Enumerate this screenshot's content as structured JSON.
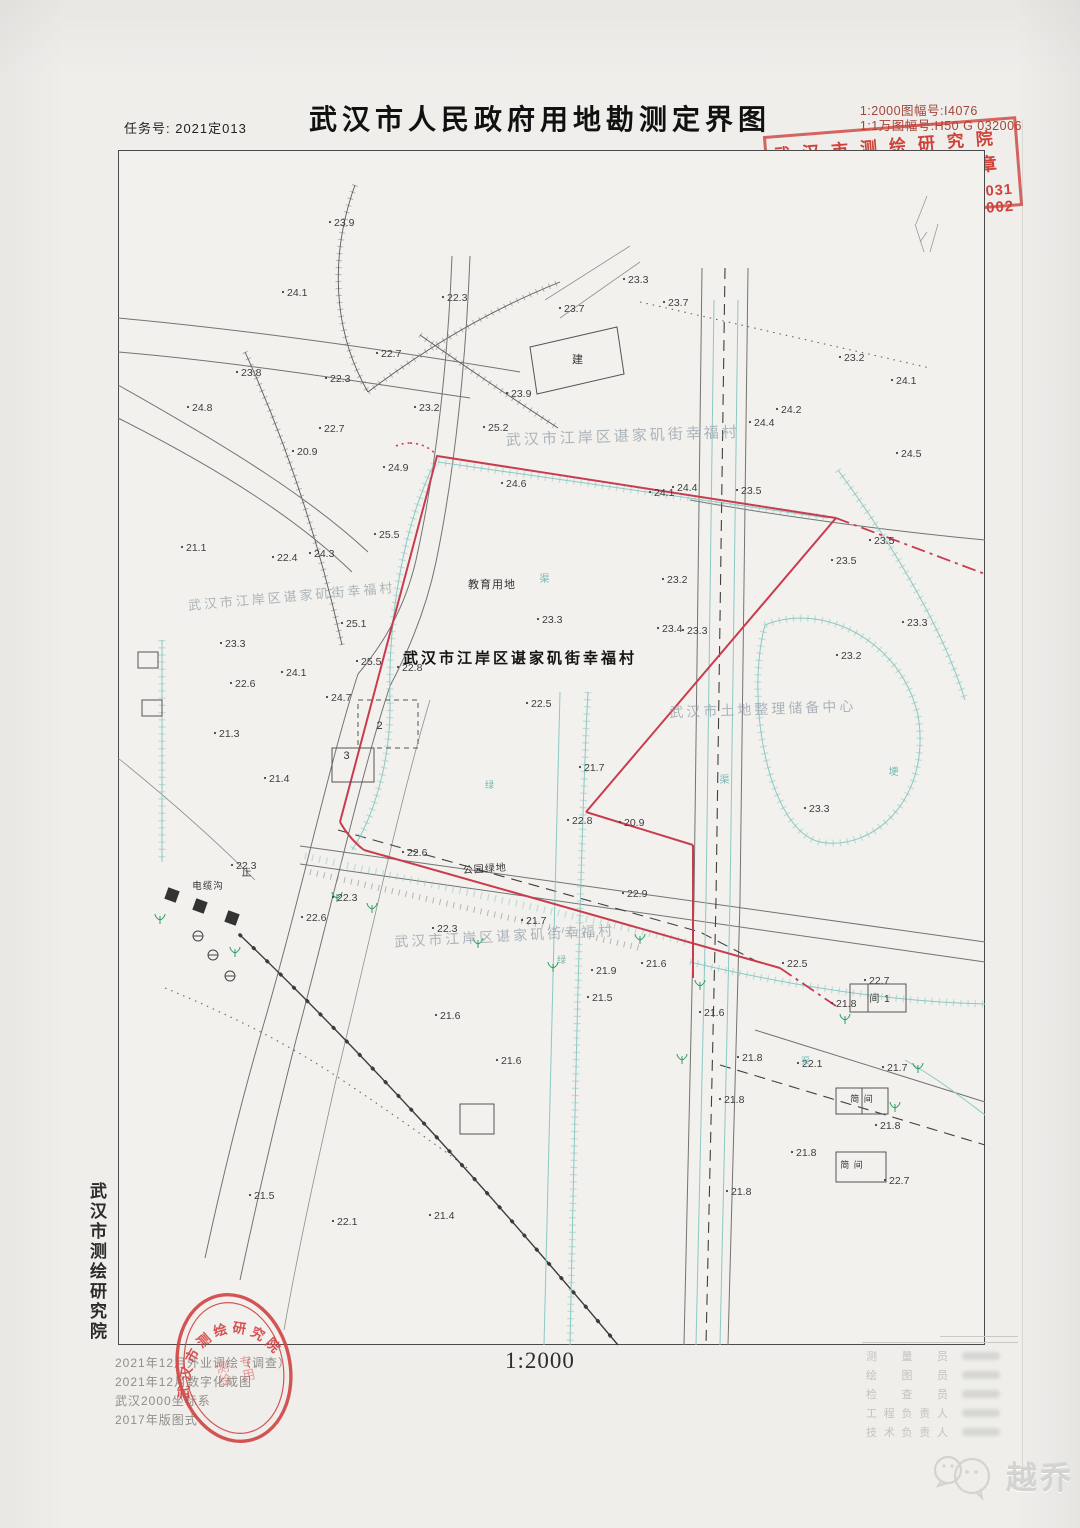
{
  "page": {
    "task_no": "任务号: 2021定013",
    "title": "武汉市人民政府用地勘测定界图",
    "sheet_no_2000": "1:2000图幅号:I4076",
    "sheet_no_10000": "1:1万图幅号:H50 G 032006",
    "scale": "1:2000",
    "watermark": "越乔"
  },
  "stamp": {
    "org": "武汉市测绘研究院",
    "seal_type": "勘测定界专用章",
    "grade_label": "测绘甲级",
    "cert_label": "甲测资字",
    "cert_no": "42002031",
    "right_label": "土地产权定界勘测",
    "cert_no2": "[2002]002"
  },
  "oval_stamp": {
    "arc": "武汉市测绘研究院",
    "center_col1": "测绘",
    "center_col2": "专用"
  },
  "side_org": "武汉市测绘研究院",
  "notes": [
    "2021年12月外业调绘（调查）",
    "2021年12月数字化成图",
    "武汉2000坐标系",
    "2017年版图式"
  ],
  "signatures": {
    "roles": [
      "测量员",
      "绘图员",
      "检查员",
      "工程负责人",
      "技术负责人"
    ]
  },
  "map": {
    "colors": {
      "boundary_red": "#c83c4e",
      "stamp_red": "#cd352d",
      "channel_teal": "#8cc8c3",
      "faded_label": "#9aa6ae",
      "tree_green": "#2e9e62"
    },
    "labels": [
      {
        "t": "武汉市江岸区谌家矶街幸福村",
        "x": 623,
        "y": 441,
        "s": 15,
        "c": "lbf",
        "r": -2
      },
      {
        "t": "武汉市江岸区谌家矶街幸福村",
        "x": 292,
        "y": 601,
        "s": 13,
        "c": "lbf",
        "r": -5
      },
      {
        "t": "武汉市江岸区谌家矶街幸福村",
        "x": 520,
        "y": 663,
        "s": 15,
        "c": "lbb",
        "r": 0
      },
      {
        "t": "武汉市江岸区谌家矶街幸福村",
        "x": 505,
        "y": 941,
        "s": 14,
        "c": "lbf",
        "r": -3
      },
      {
        "t": "武汉市土地整理储备中心",
        "x": 763,
        "y": 714,
        "s": 14,
        "c": "lbf",
        "r": -2
      },
      {
        "t": "教育用地",
        "x": 492,
        "y": 588,
        "s": 11,
        "c": "lbp",
        "r": 0
      },
      {
        "t": "公园绿地",
        "x": 485,
        "y": 872,
        "s": 10,
        "c": "lbp",
        "r": -4
      },
      {
        "t": "建",
        "x": 578,
        "y": 363,
        "s": 11,
        "c": "lbp",
        "r": 0
      },
      {
        "t": "电缆沟",
        "x": 208,
        "y": 889,
        "s": 9.5,
        "c": "lbp",
        "r": 0
      },
      {
        "t": "止",
        "x": 247,
        "y": 876,
        "s": 10,
        "c": "lbp",
        "r": 0
      },
      {
        "t": "2",
        "x": 380,
        "y": 729,
        "s": 11,
        "c": "lbp",
        "r": 0
      },
      {
        "t": "3",
        "x": 347,
        "y": 759,
        "s": 11,
        "c": "lbp",
        "r": 0
      },
      {
        "t": "间 1",
        "x": 880,
        "y": 1002,
        "s": 10,
        "c": "lbp",
        "r": 0
      },
      {
        "t": "简 间",
        "x": 862,
        "y": 1102,
        "s": 9,
        "c": "lbp",
        "r": 0
      },
      {
        "t": "简 间",
        "x": 852,
        "y": 1168,
        "s": 9,
        "c": "lbp",
        "r": 0
      },
      {
        "t": "渠",
        "x": 545,
        "y": 582,
        "s": 10,
        "c": "lbt",
        "r": 0
      },
      {
        "t": "渠",
        "x": 725,
        "y": 783,
        "s": 10,
        "c": "lbt",
        "r": 0
      },
      {
        "t": "埂",
        "x": 894,
        "y": 775,
        "s": 10,
        "c": "lbt",
        "r": 0
      },
      {
        "t": "绿",
        "x": 490,
        "y": 788,
        "s": 9,
        "c": "lbt",
        "r": 0
      },
      {
        "t": "绿",
        "x": 562,
        "y": 963,
        "s": 9,
        "c": "lbt",
        "r": 0
      },
      {
        "t": "渠",
        "x": 806,
        "y": 1064,
        "s": 9,
        "c": "lbt",
        "r": 0
      }
    ],
    "elevations": [
      [
        330,
        222,
        "23.9"
      ],
      [
        283,
        292,
        "24.1"
      ],
      [
        624,
        279,
        "23.3"
      ],
      [
        664,
        302,
        "23.7"
      ],
      [
        560,
        308,
        "23.7"
      ],
      [
        840,
        357,
        "23.2"
      ],
      [
        892,
        380,
        "24.1"
      ],
      [
        443,
        297,
        "22.3"
      ],
      [
        377,
        353,
        "22.7"
      ],
      [
        326,
        378,
        "22.3"
      ],
      [
        237,
        372,
        "23.8"
      ],
      [
        188,
        407,
        "24.8"
      ],
      [
        293,
        451,
        "20.9"
      ],
      [
        320,
        428,
        "22.7"
      ],
      [
        384,
        467,
        "24.9"
      ],
      [
        507,
        393,
        "23.9"
      ],
      [
        415,
        407,
        "23.2"
      ],
      [
        484,
        427,
        "25.2"
      ],
      [
        502,
        483,
        "24.6"
      ],
      [
        673,
        487,
        "24.4"
      ],
      [
        650,
        492,
        "24.1"
      ],
      [
        737,
        490,
        "23.5"
      ],
      [
        777,
        409,
        "24.2"
      ],
      [
        750,
        422,
        "24.4"
      ],
      [
        897,
        453,
        "24.5"
      ],
      [
        870,
        540,
        "23.5"
      ],
      [
        832,
        560,
        "23.5"
      ],
      [
        903,
        622,
        "23.3"
      ],
      [
        837,
        655,
        "23.2"
      ],
      [
        805,
        808,
        "23.3"
      ],
      [
        182,
        547,
        "21.1"
      ],
      [
        273,
        557,
        "22.4"
      ],
      [
        310,
        553,
        "24.3"
      ],
      [
        375,
        534,
        "25.5"
      ],
      [
        342,
        623,
        "25.1"
      ],
      [
        357,
        661,
        "25.5"
      ],
      [
        282,
        672,
        "24.1"
      ],
      [
        231,
        683,
        "22.6"
      ],
      [
        327,
        697,
        "24.7"
      ],
      [
        398,
        667,
        "22.8"
      ],
      [
        215,
        733,
        "21.3"
      ],
      [
        265,
        778,
        "21.4"
      ],
      [
        221,
        643,
        "23.3"
      ],
      [
        538,
        619,
        "23.3"
      ],
      [
        663,
        579,
        "23.2"
      ],
      [
        658,
        628,
        "23.4"
      ],
      [
        683,
        630,
        "23.3"
      ],
      [
        527,
        703,
        "22.5"
      ],
      [
        580,
        767,
        "21.7"
      ],
      [
        568,
        820,
        "22.8"
      ],
      [
        620,
        822,
        "20.9"
      ],
      [
        403,
        852,
        "22.6"
      ],
      [
        232,
        865,
        "22.3"
      ],
      [
        333,
        897,
        "22.3"
      ],
      [
        302,
        917,
        "22.6"
      ],
      [
        522,
        920,
        "21.7"
      ],
      [
        623,
        893,
        "22.9"
      ],
      [
        433,
        928,
        "22.3"
      ],
      [
        592,
        970,
        "21.9"
      ],
      [
        642,
        963,
        "21.6"
      ],
      [
        700,
        1012,
        "21.6"
      ],
      [
        832,
        1003,
        "21.8"
      ],
      [
        865,
        980,
        "22.7"
      ],
      [
        783,
        963,
        "22.5"
      ],
      [
        738,
        1057,
        "21.8"
      ],
      [
        798,
        1063,
        "22.1"
      ],
      [
        883,
        1067,
        "21.7"
      ],
      [
        720,
        1099,
        "21.8"
      ],
      [
        876,
        1125,
        "21.8"
      ],
      [
        792,
        1152,
        "21.8"
      ],
      [
        885,
        1180,
        "22.7"
      ],
      [
        727,
        1191,
        "21.8"
      ],
      [
        250,
        1195,
        "21.5"
      ],
      [
        333,
        1221,
        "22.1"
      ],
      [
        430,
        1215,
        "21.4"
      ],
      [
        436,
        1015,
        "21.6"
      ],
      [
        497,
        1060,
        "21.6"
      ],
      [
        588,
        997,
        "21.5"
      ]
    ],
    "symbols": {
      "trees": [
        [
          337,
          902
        ],
        [
          372,
          913
        ],
        [
          478,
          948
        ],
        [
          640,
          944
        ],
        [
          700,
          990
        ],
        [
          845,
          1024
        ],
        [
          918,
          1073
        ],
        [
          895,
          1112
        ],
        [
          553,
          972
        ],
        [
          682,
          1064
        ],
        [
          235,
          957
        ],
        [
          160,
          924
        ]
      ],
      "utility_boxes": [
        [
          172,
          895
        ],
        [
          200,
          906
        ],
        [
          232,
          918
        ]
      ],
      "utility_circles": [
        [
          198,
          936
        ],
        [
          213,
          955
        ],
        [
          230,
          976
        ]
      ],
      "pylon": [
        926,
        252
      ]
    }
  }
}
